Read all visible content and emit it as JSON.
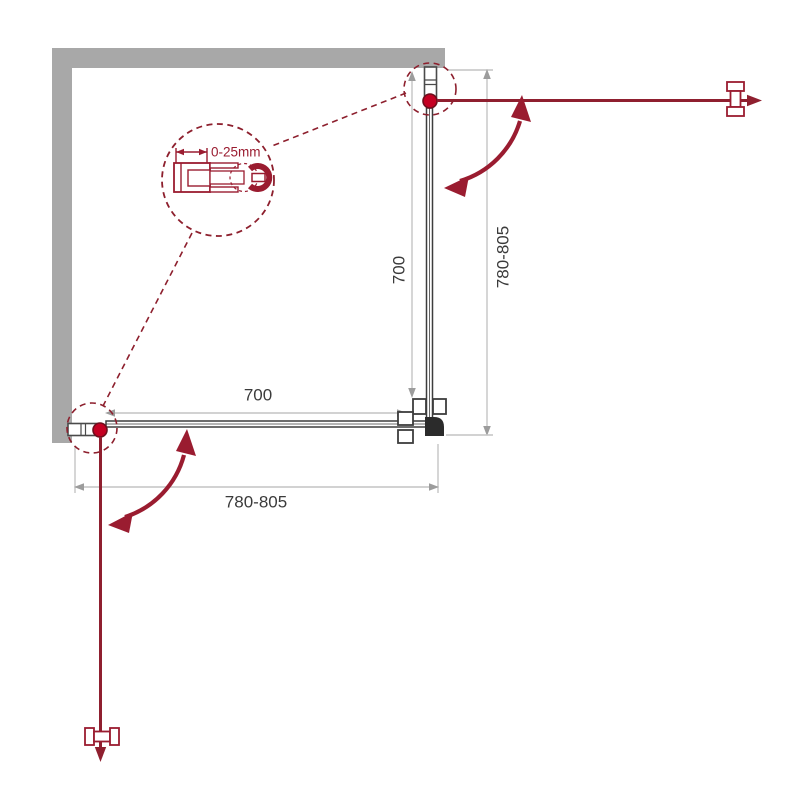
{
  "title": "Shower enclosure installation diagram",
  "labels": {
    "detail_adjustment": "0-25mm",
    "height_total": "780-805",
    "width_total": "780-805",
    "panel_height": "700",
    "panel_width": "700"
  },
  "colors": {
    "wall_gray": "#a8a8a8",
    "dimension_line": "#c4c4c4",
    "dimension_arrow": "#9c9c9c",
    "dimension_text": "#3b3b3b",
    "drawing_red": "#9a1c30",
    "hinge_red": "#c40022",
    "panel_dark": "#3d3d3d"
  }
}
